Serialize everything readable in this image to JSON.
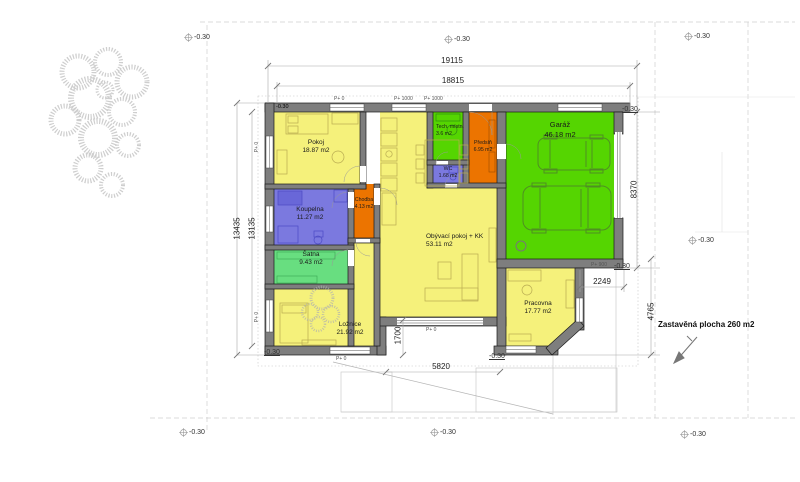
{
  "colors": {
    "yellow": "#f5f17b",
    "blue": "#7b79df",
    "soft_green": "#68de80",
    "vivid_green": "#55d501",
    "orange": "#ec7400",
    "wall": "#7e7e7e"
  },
  "rooms": [
    {
      "name": "Pokoj",
      "area": "18.87 m2",
      "color": "#f5f17b"
    },
    {
      "name": "Koupelna",
      "area": "11.27 m2",
      "color": "#7b79df"
    },
    {
      "name": "Šatna",
      "area": "9.43 m2",
      "color": "#68de80"
    },
    {
      "name": "Ložnice",
      "area": "21.92 m2",
      "color": "#f5f17b"
    },
    {
      "name": "Chodba",
      "area": "4.13 m2",
      "color": "#ec7400"
    },
    {
      "name": "Obývací pokoj + KK",
      "area": "53.11 m2",
      "color": "#f5f17b"
    },
    {
      "name": "Tech. místn.",
      "area": "3.6 m2",
      "color": "#55d501"
    },
    {
      "name": "WC",
      "area": "1.68 m2",
      "color": "#7b79df"
    },
    {
      "name": "Předsíň",
      "area": "6.95 m2",
      "color": "#ec7400"
    },
    {
      "name": "Garáž",
      "area": "46.18 m2",
      "color": "#55d501"
    },
    {
      "name": "Pracovna",
      "area": "17.77 m2",
      "color": "#f5f17b"
    }
  ],
  "dims": [
    {
      "v": "19115"
    },
    {
      "v": "18815"
    },
    {
      "v": "13435"
    },
    {
      "v": "13135"
    },
    {
      "v": "8370"
    },
    {
      "v": "4765"
    },
    {
      "v": "2249"
    },
    {
      "v": "5820"
    },
    {
      "v": "1700"
    }
  ],
  "elevation_markers": [
    {
      "v": "-0.30"
    },
    {
      "v": "-0.30"
    },
    {
      "v": "-0.30"
    },
    {
      "v": "-0.30"
    },
    {
      "v": "-0.30"
    },
    {
      "v": "-0.30"
    },
    {
      "v": "-0.30"
    },
    {
      "v": "-0.30"
    },
    {
      "v": "-0.30"
    },
    {
      "v": "-0.30"
    },
    {
      "v": "-0.30"
    }
  ],
  "corner_level": "-0.30",
  "parapet_labels": [
    {
      "v": "P+ 0"
    },
    {
      "v": "P+ 1000"
    },
    {
      "v": "P+ 1000"
    },
    {
      "v": "P+ 900"
    },
    {
      "v": "P+ 0"
    },
    {
      "v": "P+ 0"
    },
    {
      "v": "P+ 0"
    },
    {
      "v": "P+ 0"
    }
  ],
  "site": {
    "built_area": "Zastavěná plocha 260 m2"
  }
}
